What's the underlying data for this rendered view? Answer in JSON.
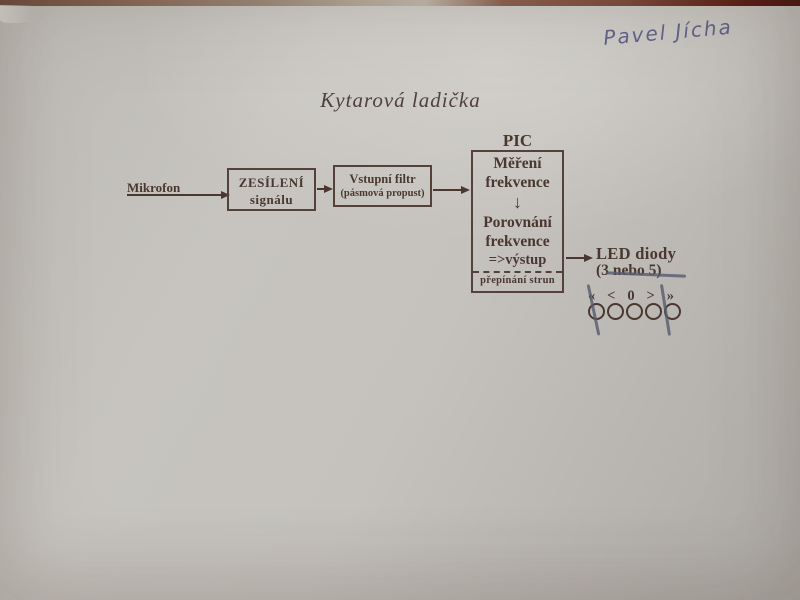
{
  "photo": {
    "signature": "Pavel Jícha",
    "title": "Kytarová ladička"
  },
  "blocks": {
    "mikrofon": "Mikrofon",
    "zesileni_line1": "ZESÍLENÍ",
    "zesileni_line2": "signálu",
    "filtr_line1": "Vstupní filtr",
    "filtr_line2": "(pásmová propust)",
    "pic_label": "PIC",
    "pic_mereni_1": "Měření",
    "pic_mereni_2": "frekvence",
    "pic_down_arrow": "↓",
    "pic_porovnani_1": "Porovnání",
    "pic_porovnani_2": "frekvence",
    "pic_vystup": "=>výstup",
    "pic_prepinani": "přepínání strun"
  },
  "led": {
    "title": "LED diody",
    "count_prefix": "(3",
    "count_struck": "nebo 5",
    "count_suffix": ")",
    "symbols": [
      "«",
      "<",
      "0",
      ">",
      "»"
    ],
    "circle_count": 5
  },
  "colors": {
    "ink": "#4a3830",
    "pen_ink": "#565a6e",
    "signature_ink": "#4e5180",
    "paper": "#c2bfba",
    "table_edge": "#5a2a1c"
  }
}
